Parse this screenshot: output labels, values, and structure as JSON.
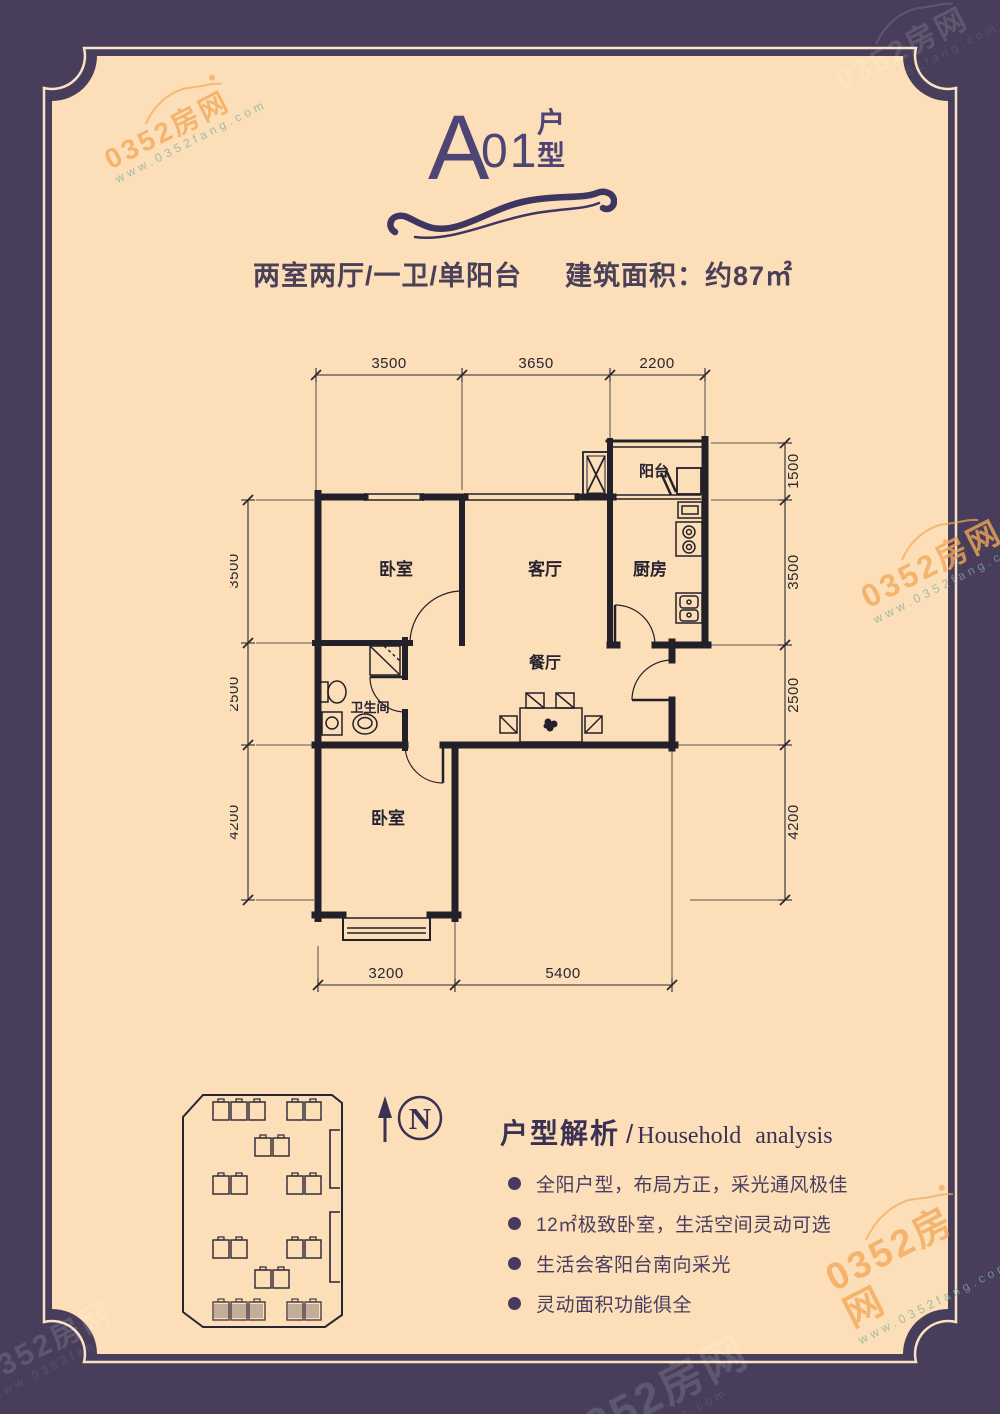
{
  "colors": {
    "frame": "#483e5b",
    "panel": "#fcdfb8",
    "plan_ink": "#23202a",
    "title": "#4d4574",
    "accent_orange": "#f2a858"
  },
  "watermark": {
    "text": "0352房网",
    "url": "www.0352fang.com"
  },
  "header": {
    "title_main": "A",
    "title_num": "01",
    "suffix": [
      "户",
      "型"
    ],
    "layout_spec": "两室两厅/一卫/单阳台",
    "area": "建筑面积：约87㎡"
  },
  "plan": {
    "rooms": {
      "bedroom_top": "卧室",
      "living": "客厅",
      "kitchen": "厨房",
      "balcony": "阳台",
      "bathroom": "卫生间",
      "dining": "餐厅",
      "bedroom_bottom": "卧室"
    },
    "dims_top": [
      "3500",
      "3650",
      "2200"
    ],
    "dims_left": [
      "3500",
      "2500",
      "4200"
    ],
    "dims_right": [
      "1500",
      "3500",
      "2500",
      "4200"
    ],
    "dims_bottom": [
      "3200",
      "5400"
    ]
  },
  "compass": {
    "label": "N"
  },
  "analysis": {
    "title_cn": "户型解析",
    "separator": "/",
    "title_en": "Household  analysis",
    "bullets": [
      "全阳户型，布局方正，采光通风极佳",
      "12㎡极致卧室，生活空间灵动可选",
      "生活会客阳台南向采光",
      "灵动面积功能俱全"
    ]
  }
}
